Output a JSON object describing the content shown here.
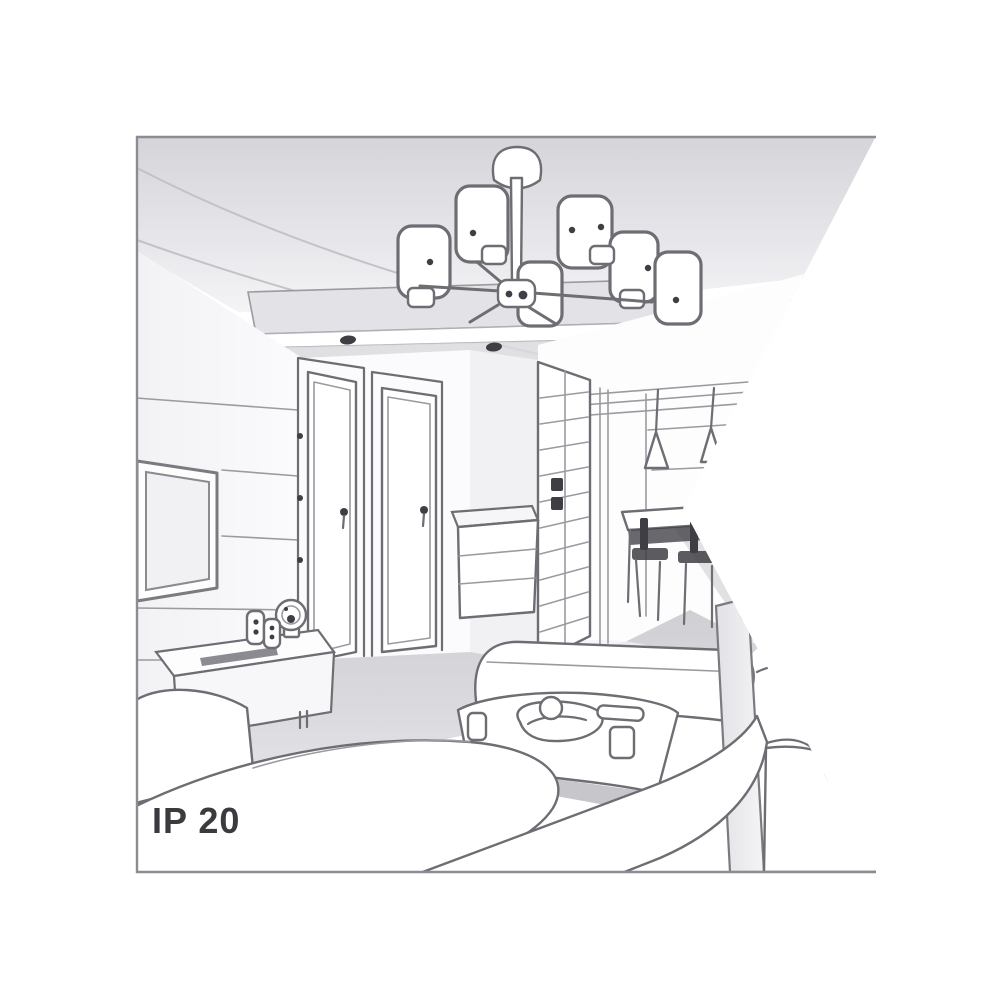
{
  "illustration": {
    "kind": "interior-room-line-drawing",
    "caption": "IP 20",
    "scene_items": [
      "ceiling-chandelier-six-drum-shades",
      "recessed-ceiling-spotlights",
      "wall-tv-panel",
      "tv-sideboard-with-clock-and-speakers",
      "interior-door-left",
      "interior-door-right",
      "hallway-wardrobe-glass-doors",
      "hallway-dresser",
      "dining-table-with-chairs",
      "cone-pendant-lamps",
      "white-corner-sofa",
      "coffee-table-with-tray-and-cups"
    ]
  },
  "colors": {
    "background": "#ffffff",
    "border": "#8c8c92",
    "line": "#6d6d73",
    "line_soft": "#c2c2c8",
    "dark_accent": "#3e3e44",
    "ceiling_gray": "#d7d7db",
    "panel_gray": "#e3e3e7",
    "floor_gray": "#d6d6da",
    "caption_text": "#3a3a3f"
  }
}
